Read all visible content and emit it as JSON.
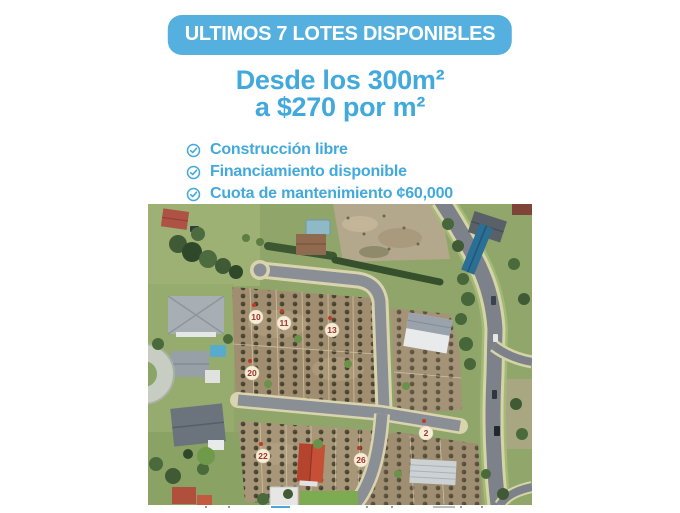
{
  "banner": {
    "text": "ULTIMOS 7 LOTES DISPONIBLES"
  },
  "headline": {
    "line1": "Desde los 300m²",
    "line2": "a $270 por m²"
  },
  "features": [
    {
      "icon": "check-circle-icon",
      "label": "Construcción libre"
    },
    {
      "icon": "check-circle-icon",
      "label": "Financiamiento disponible"
    },
    {
      "icon": "check-circle-icon",
      "label": "Cuota de mantenimiento ¢60,000"
    }
  ],
  "map": {
    "type": "aerial-photo-of-residential-lots",
    "lots": [
      {
        "label": "10"
      },
      {
        "label": "11"
      },
      {
        "label": "13"
      },
      {
        "label": "20"
      },
      {
        "label": "22"
      },
      {
        "label": "26"
      },
      {
        "label": "2"
      }
    ]
  },
  "colors": {
    "banner_bg": "#55b0e0",
    "banner_text": "#ffffff",
    "headline_text": "#42a9dc",
    "feature_text": "#42a9dc",
    "lot_badge_fill": "#f4edda",
    "lot_badge_number": "#a33426"
  }
}
